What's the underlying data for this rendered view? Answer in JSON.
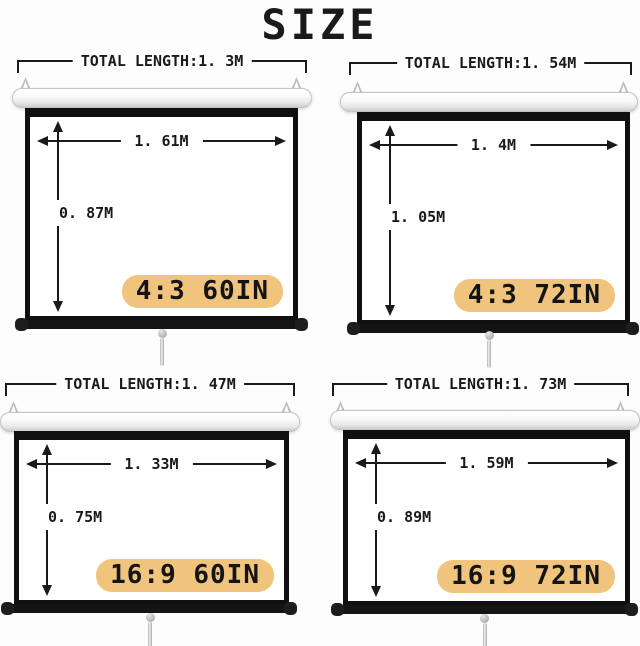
{
  "title": "SIZE",
  "colors": {
    "badge_bg": "#f1c47e",
    "line": "#1a1a1a",
    "background": "#fdfdfd"
  },
  "panels": [
    {
      "total_length": "TOTAL LENGTH:1. 3M",
      "width": "1. 61M",
      "height": "0. 87M",
      "badge": "4:3 60IN"
    },
    {
      "total_length": "TOTAL LENGTH:1. 54M",
      "width": "1. 4M",
      "height": "1. 05M",
      "badge": "4:3 72IN"
    },
    {
      "total_length": "TOTAL LENGTH:1. 47M",
      "width": "1. 33M",
      "height": "0. 75M",
      "badge": "16:9 60IN"
    },
    {
      "total_length": "TOTAL LENGTH:1. 73M",
      "width": "1. 59M",
      "height": "0. 89M",
      "badge": "16:9 72IN"
    }
  ]
}
